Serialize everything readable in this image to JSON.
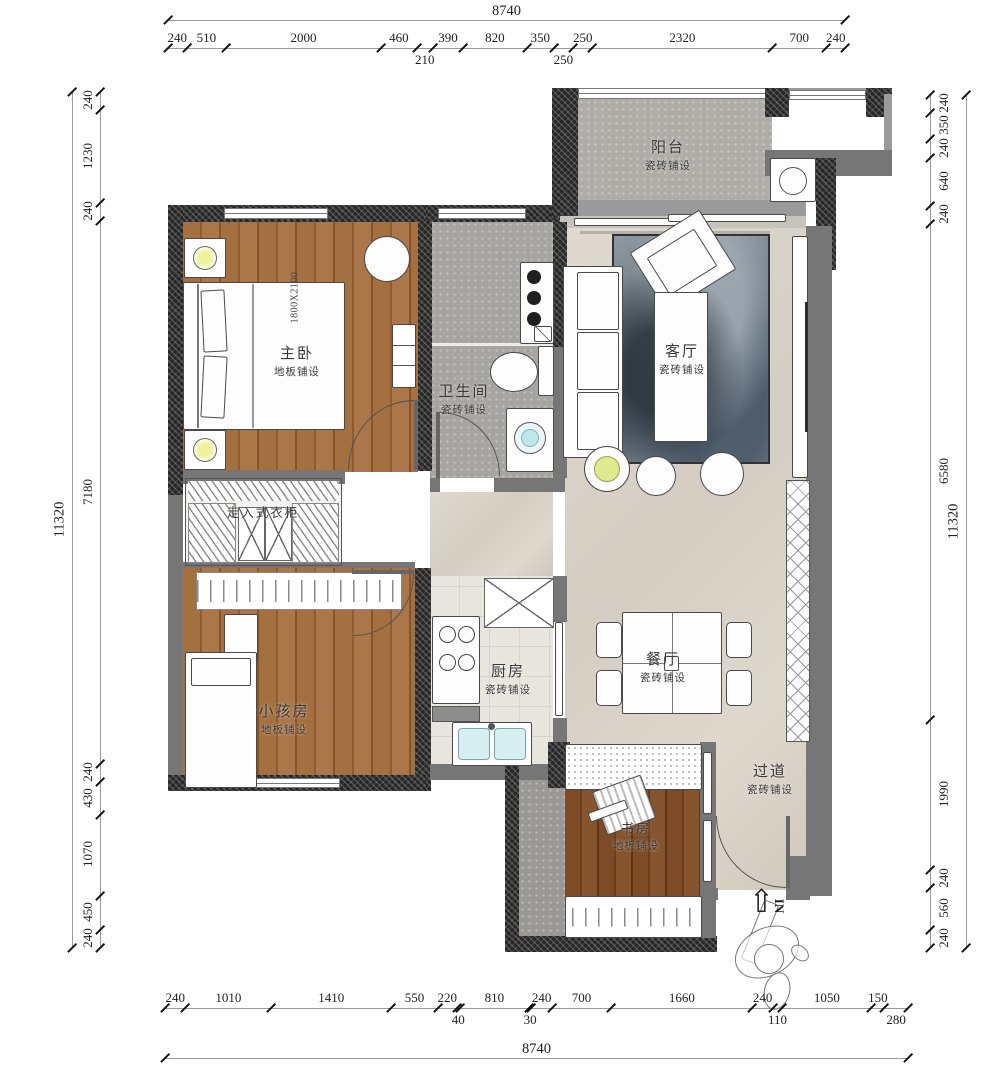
{
  "drawing": {
    "type": "apartment-floor-plan",
    "units": "mm"
  },
  "dims": {
    "top": {
      "total": "8740",
      "segments": [
        {
          "v": "240"
        },
        {
          "v": "510"
        },
        {
          "v": "2000"
        },
        {
          "v": "460"
        },
        {
          "v": "210",
          "row": 2
        },
        {
          "v": "390"
        },
        {
          "v": "820"
        },
        {
          "v": "350"
        },
        {
          "v": "250",
          "row": 2
        },
        {
          "v": "250"
        },
        {
          "v": "2320"
        },
        {
          "v": "700"
        },
        {
          "v": "240"
        }
      ]
    },
    "bottom": {
      "total": "8740",
      "segments": [
        {
          "v": "240"
        },
        {
          "v": "1010"
        },
        {
          "v": "1410"
        },
        {
          "v": "550"
        },
        {
          "v": "220"
        },
        {
          "v": "40",
          "row": 2
        },
        {
          "v": "810"
        },
        {
          "v": "30",
          "row": 2
        },
        {
          "v": "240"
        },
        {
          "v": "700"
        },
        {
          "v": "1660"
        },
        {
          "v": "240"
        },
        {
          "v": "110",
          "row": 2
        },
        {
          "v": "1050"
        },
        {
          "v": "150"
        },
        {
          "v": "280",
          "row": 2
        }
      ]
    },
    "left": {
      "total": "11320",
      "segments": [
        {
          "v": "240"
        },
        {
          "v": "1230"
        },
        {
          "v": "240"
        },
        {
          "v": "7180"
        },
        {
          "v": "240"
        },
        {
          "v": "430"
        },
        {
          "v": "1070"
        },
        {
          "v": "450"
        },
        {
          "v": "240"
        }
      ]
    },
    "right": {
      "total": "11320",
      "segments": [
        {
          "v": "240"
        },
        {
          "v": "350"
        },
        {
          "v": "240"
        },
        {
          "v": "640"
        },
        {
          "v": "240"
        },
        {
          "v": "6580"
        },
        {
          "v": "1990"
        },
        {
          "v": "240"
        },
        {
          "v": "560"
        },
        {
          "v": "240"
        }
      ]
    }
  },
  "rooms": [
    {
      "name": "阳台",
      "sub": "瓷砖铺设"
    },
    {
      "name": "主卧",
      "sub": "地板铺设"
    },
    {
      "name": "卫生间",
      "sub": "瓷砖铺设"
    },
    {
      "name": "客厅",
      "sub": "瓷砖铺设"
    },
    {
      "name": "走入式衣柜",
      "sub": ""
    },
    {
      "name": "小孩房",
      "sub": "地板铺设"
    },
    {
      "name": "厨房",
      "sub": "瓷砖铺设"
    },
    {
      "name": "餐厅",
      "sub": "瓷砖铺设"
    },
    {
      "name": "过道",
      "sub": "瓷砖铺设"
    },
    {
      "name": "书房",
      "sub": "地板铺设"
    }
  ],
  "annotations": {
    "bed_size": "1800X2100",
    "entrance": "IN"
  },
  "palette": {
    "wall_dark": "#262626",
    "wall_grey": "#767676",
    "wood": "#9a6a3c",
    "tile_grey": "#b0ada8",
    "marble": "#d8d2c8",
    "rug_blue": "#5a6673",
    "sink_cyan": "#bfe6ea",
    "lamp_yellow": "#eef39b"
  }
}
